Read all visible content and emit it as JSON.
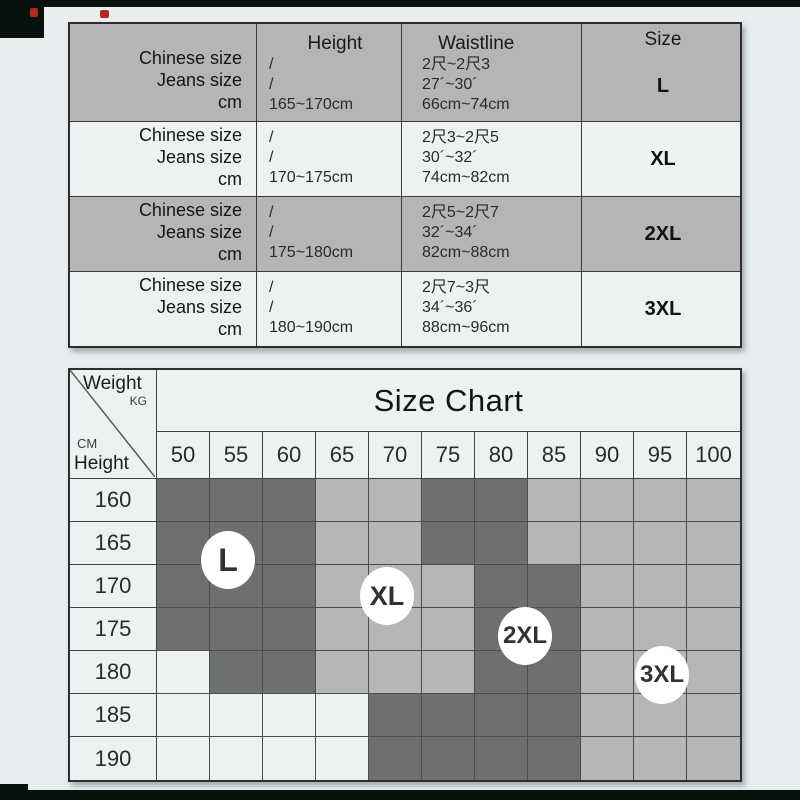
{
  "colors": {
    "frame": "#0a120d",
    "page_bg": "#e8edef",
    "table_shaded_row": "#b5b5b5",
    "table_light_row": "#eef1f2",
    "grid_dark": "#6e6f6f",
    "grid_medium": "#b5b6b6",
    "grid_light": "#eef1f2",
    "red_artifact": "#b5281f"
  },
  "size_table": {
    "row_header_lines": [
      "Chinese size",
      "Jeans size",
      "cm"
    ],
    "columns": [
      "Height",
      "Waistline",
      "Size"
    ],
    "rows": [
      {
        "shaded": true,
        "height_lines": [
          "/",
          "/",
          "165~170cm"
        ],
        "waistline_lines": [
          "2尺~2尺3",
          "27´~30´",
          "66cm~74cm"
        ],
        "size": "L"
      },
      {
        "shaded": false,
        "height_lines": [
          "/",
          "/",
          "170~175cm"
        ],
        "waistline_lines": [
          "2尺3~2尺5",
          "30´~32´",
          "74cm~82cm"
        ],
        "size": "XL"
      },
      {
        "shaded": true,
        "height_lines": [
          "/",
          "/",
          "175~180cm"
        ],
        "waistline_lines": [
          "2尺5~2尺7",
          "32´~34´",
          "82cm~88cm"
        ],
        "size": "2XL"
      },
      {
        "shaded": false,
        "height_lines": [
          "/",
          "/",
          "180~190cm"
        ],
        "waistline_lines": [
          "2尺7~3尺",
          "34´~36´",
          "88cm~96cm"
        ],
        "size": "3XL"
      }
    ]
  },
  "chart_data": {
    "type": "heatmap",
    "title": "Size Chart",
    "x_label": "Weight",
    "x_unit": "KG",
    "y_label": "Height",
    "y_unit": "CM",
    "weights": [
      "50",
      "55",
      "60",
      "65",
      "70",
      "75",
      "80",
      "85",
      "90",
      "95",
      "100"
    ],
    "heights": [
      "160",
      "165",
      "170",
      "175",
      "180",
      "185",
      "190"
    ],
    "cells": [
      [
        "L",
        "L",
        "L",
        "XL",
        "XL",
        "2XL",
        "2XL",
        "3XL",
        "3XL",
        "3XL",
        "3XL"
      ],
      [
        "L",
        "L",
        "L",
        "XL",
        "XL",
        "2XL",
        "2XL",
        "3XL",
        "3XL",
        "3XL",
        "3XL"
      ],
      [
        "L",
        "L",
        "L",
        "XL",
        "XL",
        "XL",
        "2XL",
        "2XL",
        "3XL",
        "3XL",
        "3XL"
      ],
      [
        "L",
        "L",
        "L",
        "XL",
        "XL",
        "XL",
        "2XL",
        "2XL",
        "3XL",
        "3XL",
        "3XL"
      ],
      [
        "",
        "L",
        "L",
        "XL",
        "XL",
        "XL",
        "2XL",
        "2XL",
        "3XL",
        "3XL",
        "3XL"
      ],
      [
        "",
        "",
        "",
        "",
        "2XL",
        "2XL",
        "2XL",
        "2XL",
        "3XL",
        "3XL",
        "3XL"
      ],
      [
        "",
        "",
        "",
        "",
        "2XL",
        "2XL",
        "2XL",
        "2XL",
        "3XL",
        "3XL",
        "3XL"
      ]
    ],
    "size_shade": {
      "L": "dark",
      "XL": "medium",
      "2XL": "dark",
      "3XL": "medium",
      "": "light"
    },
    "annotations": [
      {
        "text": "L",
        "x": 158,
        "y": 190
      },
      {
        "text": "XL",
        "x": 317,
        "y": 226
      },
      {
        "text": "2XL",
        "x": 455,
        "y": 266
      },
      {
        "text": "3XL",
        "x": 592,
        "y": 305
      }
    ]
  }
}
